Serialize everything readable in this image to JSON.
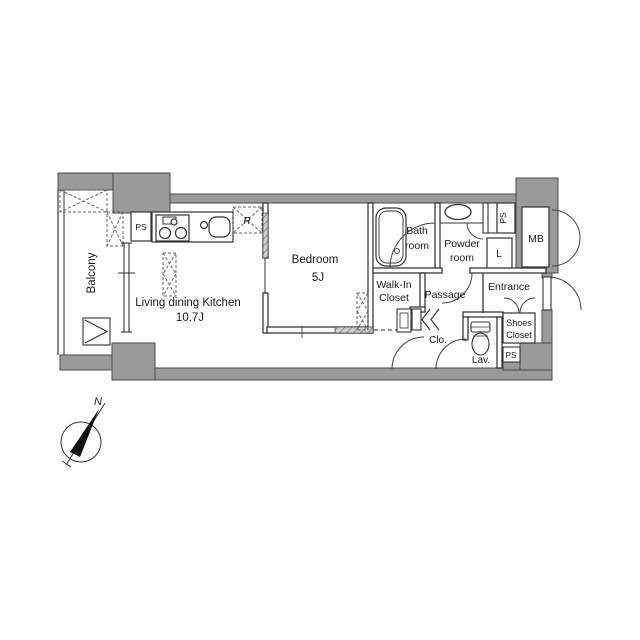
{
  "labels": {
    "balcony": "Balcony",
    "ldk_line1": "Living dining Kitchen",
    "ldk_line2": "10.7J",
    "bedroom_line1": "Bedroom",
    "bedroom_line2": "5J",
    "bath_line1": "Bath",
    "bath_line2": "room",
    "powder_line1": "Powder",
    "powder_line2": "room",
    "wic_line1": "Walk-In",
    "wic_line2": "Closet",
    "passage": "Passage",
    "entrance": "Entrance",
    "clo": "Clo.",
    "lav": "Lav.",
    "shoes_line1": "Shoes",
    "shoes_line2": "Closet",
    "mb": "MB",
    "laundry": "L",
    "refrigerator": "R",
    "ps_kitchen": "PS",
    "ps_powder": "PS",
    "ps_entry": "PS",
    "compass_north": "N"
  },
  "colors": {
    "wall": "#9a9a9a",
    "wall_edge": "#4a4a4a",
    "line": "#333333",
    "text": "#1a1a1a",
    "background": "#ffffff"
  }
}
